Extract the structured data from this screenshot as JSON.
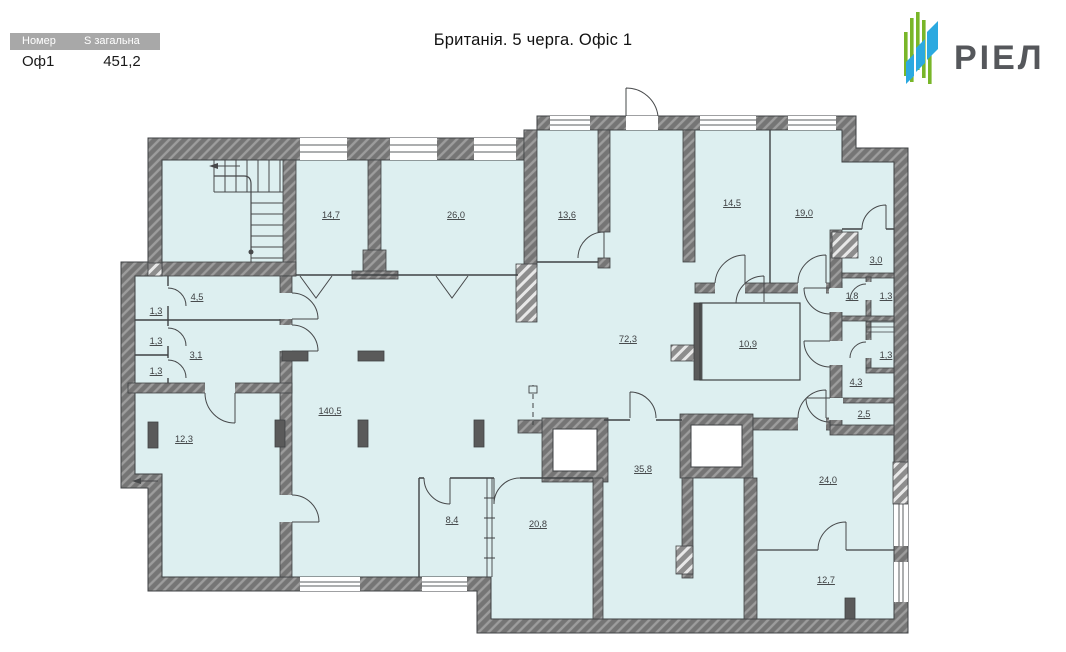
{
  "header": {
    "title": "Британія. 5 черга. Офіс 1",
    "table": {
      "col1_header": "Номер",
      "col2_header": "S загальна",
      "number": "Оф1",
      "total_area": "451,2"
    },
    "logo_text": "РІЕЛ"
  },
  "colors": {
    "room_fill": "#ddeff0",
    "wall_gray": "#757575",
    "wall_hatch": "#9d9d9d",
    "line": "#3f4244",
    "table_header_bg": "#a8a8a8",
    "logo_green": "#79b629",
    "logo_blue": "#2ba9e0",
    "logo_text_color": "#55575b"
  },
  "plan": {
    "rooms": [
      {
        "area": "14,7"
      },
      {
        "area": "26,0"
      },
      {
        "area": "13,6"
      },
      {
        "area": "14,5"
      },
      {
        "area": "19,0"
      },
      {
        "area": "3,0"
      },
      {
        "area": "4,5"
      },
      {
        "area": "1,3"
      },
      {
        "area": "1,3"
      },
      {
        "area": "3,1"
      },
      {
        "area": "1,3"
      },
      {
        "area": "1,8"
      },
      {
        "area": "1,3"
      },
      {
        "area": "72,3"
      },
      {
        "area": "10,9"
      },
      {
        "area": "1,3"
      },
      {
        "area": "4,3"
      },
      {
        "area": "2,5"
      },
      {
        "area": "140,5"
      },
      {
        "area": "12,3"
      },
      {
        "area": "35,8"
      },
      {
        "area": "24,0"
      },
      {
        "area": "8,4"
      },
      {
        "area": "20,8"
      },
      {
        "area": "12,7"
      }
    ]
  }
}
